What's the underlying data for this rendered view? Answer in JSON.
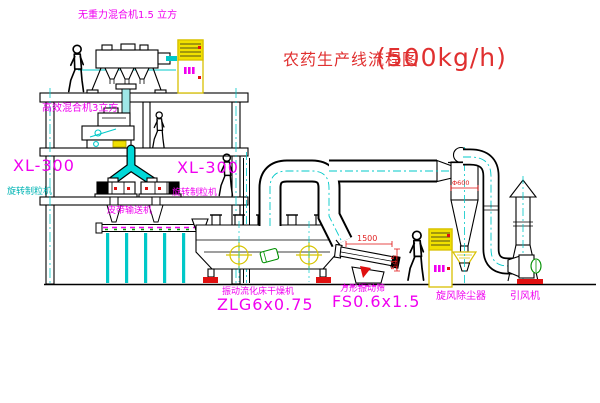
{
  "title": {
    "name": "农药生产线流程图",
    "capacity": "(500kg/h)"
  },
  "labels": {
    "gravity_mixer": "无重力混合机1.5 立方",
    "high_efficiency_mixer": "高效混合机3立方",
    "granulator_left_model": "XL-300",
    "granulator_left_name": "旋转制粒机",
    "granulator_center_model": "XL-300",
    "granulator_center_name": "旋转制粒机",
    "belt_conveyor": "皮带输送机",
    "dryer_name": "振动流化床干燥机",
    "dryer_model": "ZLG6x0.75",
    "sieve_name": "方形振动筛",
    "sieve_model": "FS0.6x1.5",
    "cyclone": "旋风除尘器",
    "fan": "引风机"
  },
  "dimensions": {
    "sieve_length": "1500",
    "sieve_height": "545",
    "cyclone_diameter": "Φ600"
  },
  "colors": {
    "line": "#000000",
    "magenta": "#f000f0",
    "cyan": "#00c8c8",
    "yellow": "#f0e000",
    "red": "#e01010",
    "green": "#009000",
    "title_red": "#e03030",
    "background": "#ffffff"
  }
}
